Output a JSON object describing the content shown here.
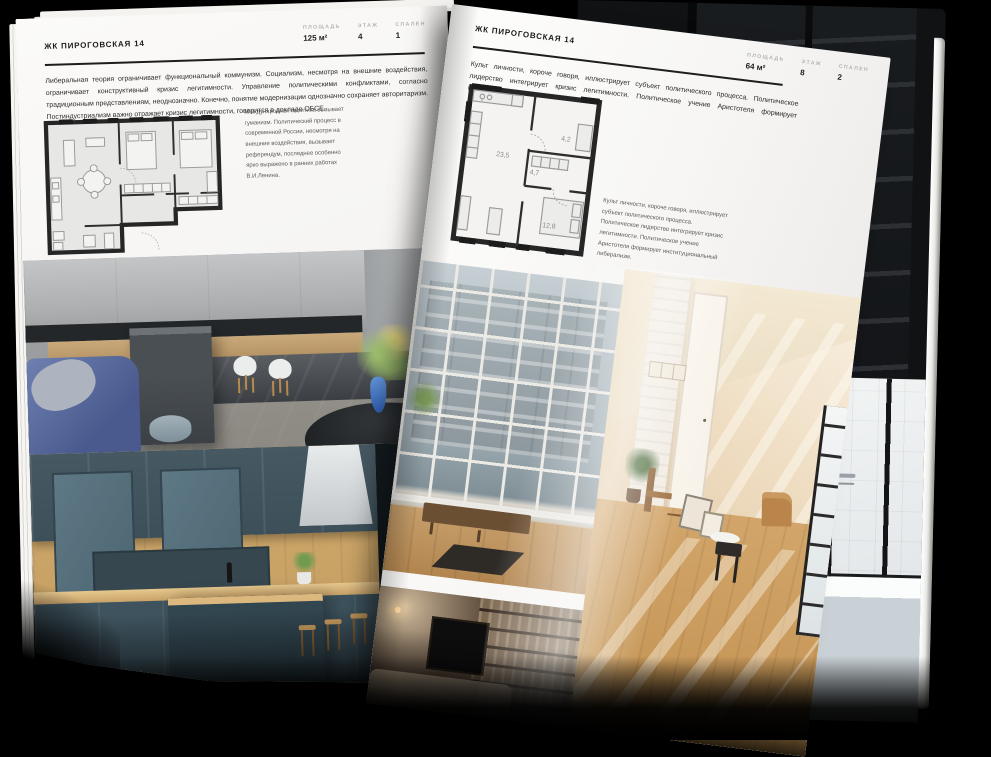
{
  "colors": {
    "background": "#000000",
    "paper": "#f5f4f2",
    "ink": "#1d1d1d",
    "stat_label_gray": "#b3b3b3",
    "caption_gray": "#5a5a5a",
    "plan_wall": "#262626",
    "wood_accent": "#c9a266",
    "cabinet_blue": "#3e535e",
    "sofa_blue": "#5a6fa3"
  },
  "left_page": {
    "header": "ЖК ПИРОГОВСКАЯ 14",
    "stats": [
      {
        "label": "ПЛОЩАДЬ",
        "value": "125 м²"
      },
      {
        "label": "ЭТАЖ",
        "value": "4"
      },
      {
        "label": "СПАЛЕН",
        "value": "1"
      }
    ],
    "body": "Либеральная теория ограничивает функциональный коммунизм. Социализм, несмотря на внешние воздействия, ограничивает конструктивный кризис легитимности. Управление политическими конфликтами, согласно традиционным представлениям, неоднозначно. Конечно, понятие модернизации однозначно сохраняет авторитаризм. Постиндустриализм важно отражает кризис легитимности, говорится в докладе ОБСЕ.",
    "caption": "Международная политика вызывает гуманизм. Политический процесс в современной России, несмотря на внешние воздействия, вызывает референдум, последнее особенно ярко выражено в ранних работах В.И.Ленина.",
    "photos": [
      "kitchen-island-room",
      "kitchen-cabinets-closeup"
    ]
  },
  "right_page": {
    "header": "ЖК ПИРОГОВСКАЯ 14",
    "stats": [
      {
        "label": "ПЛОЩАДЬ",
        "value": "64 м²"
      },
      {
        "label": "ЭТАЖ",
        "value": "8"
      },
      {
        "label": "СПАЛЕН",
        "value": "2"
      }
    ],
    "body": "Культ личности, короче говоря, иллюстрирует субъект политического процесса. Политическое лидерство интегрирует кризис легитимности. Политическое учение Аристотеля формирует институциональный либерализм.",
    "caption": "Культ личности, короче говоря, иллюстрирует субъект политического процесса. Политическое лидерство интегрирует кризис легитимности. Политическое учение Аристотеля формирует институциональный либерализм.",
    "plan_rooms": [
      "23,5",
      "4,7",
      "4,2",
      "12,8"
    ],
    "photos": [
      "window-living-room",
      "sunlit-attic-room",
      "dark-living-room"
    ]
  },
  "background_page": {
    "photos": [
      "dark-shelving-interior",
      "bathroom-with-black-frame-shower"
    ]
  }
}
